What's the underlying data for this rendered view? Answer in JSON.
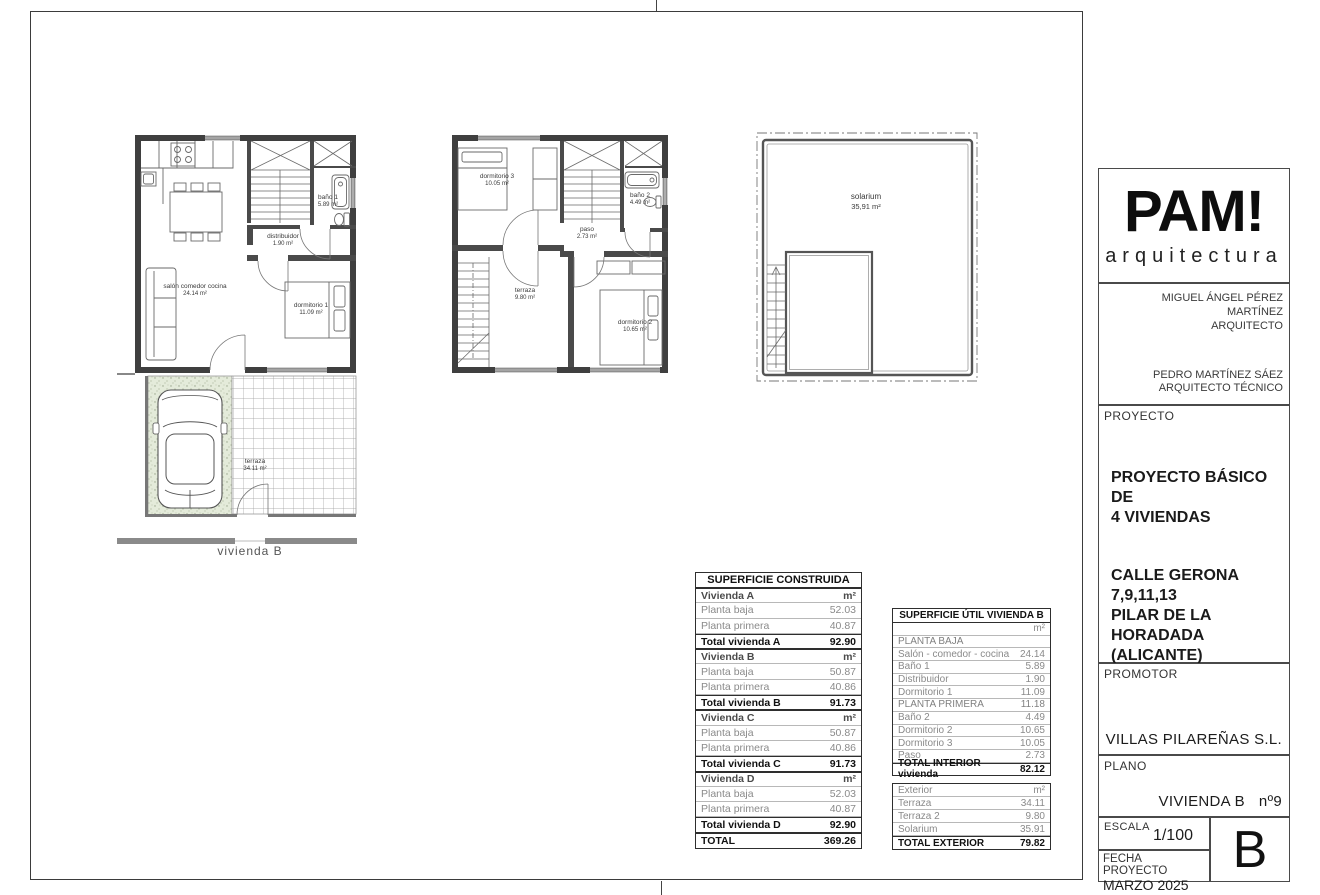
{
  "plans": {
    "planta_baja": {
      "salon": {
        "name": "salón comedor cocina",
        "area": "24.14 m²"
      },
      "distribuidor": {
        "name": "distribuidor",
        "area": "1.90 m²"
      },
      "bano1": {
        "name": "baño 1",
        "area": "5.89 m²"
      },
      "dormitorio1": {
        "name": "dormitorio 1",
        "area": "11.09 m²"
      },
      "terraza": {
        "name": "terraza",
        "area": "34.11 m²"
      },
      "caption": "vivienda B"
    },
    "planta_primera": {
      "dormitorio3": {
        "name": "dormitorio 3",
        "area": "10.05 m²"
      },
      "bano2": {
        "name": "baño 2",
        "area": "4.49 m²"
      },
      "paso": {
        "name": "paso",
        "area": "2.73 m²"
      },
      "terraza": {
        "name": "terraza",
        "area": "9.80 m²"
      },
      "dormitorio2": {
        "name": "dormitorio 2",
        "area": "10.65 m²"
      }
    },
    "solarium_plan": {
      "solarium": {
        "name": "solarium",
        "area": "35,91 m²"
      }
    }
  },
  "tables": {
    "construida": {
      "title": "SUPERFICIE CONSTRUIDA",
      "rows": [
        {
          "label": "Vivienda A",
          "value": "m²"
        },
        {
          "label": "Planta baja",
          "value": "52.03"
        },
        {
          "label": "Planta primera",
          "value": "40.87"
        },
        {
          "label": "Total vivienda A",
          "value": "92.90"
        },
        {
          "label": "Vivienda B",
          "value": "m²"
        },
        {
          "label": "Planta baja",
          "value": "50.87"
        },
        {
          "label": "Planta primera",
          "value": "40.86"
        },
        {
          "label": "Total vivienda B",
          "value": "91.73"
        },
        {
          "label": "Vivienda C",
          "value": "m²"
        },
        {
          "label": "Planta baja",
          "value": "50.87"
        },
        {
          "label": "Planta primera",
          "value": "40.86"
        },
        {
          "label": "Total vivienda C",
          "value": "91.73"
        },
        {
          "label": "Vivienda D",
          "value": "m²"
        },
        {
          "label": "Planta baja",
          "value": "52.03"
        },
        {
          "label": "Planta primera",
          "value": "40.87"
        },
        {
          "label": "Total vivienda D",
          "value": "92.90"
        },
        {
          "label": "TOTAL",
          "value": "369.26"
        }
      ]
    },
    "util": {
      "title": "SUPERFICIE ÚTIL VIVIENDA B",
      "rows": [
        {
          "label": "",
          "value": "m²"
        },
        {
          "label": "PLANTA BAJA",
          "value": ""
        },
        {
          "label": "Salón - comedor - cocina",
          "value": "24.14"
        },
        {
          "label": "Baño 1",
          "value": "5.89"
        },
        {
          "label": "Distribuidor",
          "value": "1.90"
        },
        {
          "label": "Dormitorio 1",
          "value": "11.09"
        },
        {
          "label": "PLANTA PRIMERA",
          "value": "11.18"
        },
        {
          "label": "Baño 2",
          "value": "4.49"
        },
        {
          "label": "Dormitorio 2",
          "value": "10.65"
        },
        {
          "label": "Dormitorio 3",
          "value": "10.05"
        },
        {
          "label": "Paso",
          "value": "2.73"
        },
        {
          "label": "TOTAL INTERIOR vivienda",
          "value": "82.12"
        }
      ]
    },
    "exterior": {
      "rows": [
        {
          "label": "Exterior",
          "value": "m²"
        },
        {
          "label": "Terraza",
          "value": "34.11"
        },
        {
          "label": "Terraza 2",
          "value": "9.80"
        },
        {
          "label": "Solarium",
          "value": "35.91"
        },
        {
          "label": "TOTAL EXTERIOR",
          "value": "79.82"
        }
      ]
    }
  },
  "title_block": {
    "logo_title": "PAM!",
    "logo_subtitle": "arquitectura",
    "architect_name": "MIGUEL ÁNGEL PÉREZ MARTÍNEZ",
    "architect_role": "ARQUITECTO",
    "tech_name": "PEDRO MARTÍNEZ SÁEZ",
    "tech_role": "ARQUITECTO TÉCNICO",
    "proyecto_label": "PROYECTO",
    "proyecto_line1": "PROYECTO BÁSICO DE",
    "proyecto_line2": "4 VIVIENDAS",
    "address_line1": "CALLE GERONA",
    "address_line2": "7,9,11,13",
    "address_line3": "PILAR DE LA HORADADA",
    "address_line4": "(ALICANTE)",
    "promotor_label": "PROMOTOR",
    "promotor_value": "VILLAS PILAREÑAS S.L.",
    "plano_label": "PLANO",
    "plano_value": "VIVIENDA B",
    "plano_number": "nº9",
    "escala_label": "ESCALA",
    "escala_value": "1/100",
    "fecha_label": "FECHA PROYECTO",
    "fecha_value": "MARZO 2025",
    "sheet_letter": "B"
  }
}
